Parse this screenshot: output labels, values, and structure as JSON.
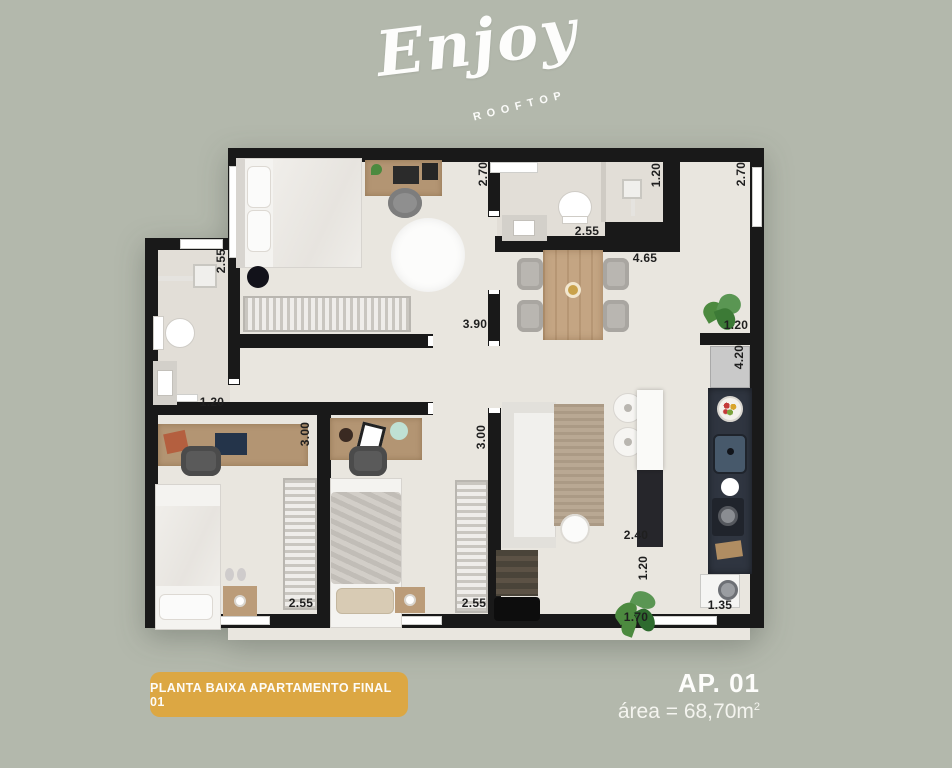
{
  "logo": {
    "brand": "Enjoy",
    "tagline": "ROOFTOP"
  },
  "plan": {
    "dimensions": [
      {
        "value": "2.70",
        "x": 338,
        "y": 28,
        "rot": true
      },
      {
        "value": "1.20",
        "x": 511,
        "y": 29,
        "rot": true
      },
      {
        "value": "2.70",
        "x": 596,
        "y": 28,
        "rot": true
      },
      {
        "value": "2.55",
        "x": 442,
        "y": 85,
        "rot": false
      },
      {
        "value": "4.65",
        "x": 500,
        "y": 112,
        "rot": false
      },
      {
        "value": "2.55",
        "x": 76,
        "y": 115,
        "rot": true
      },
      {
        "value": "3.90",
        "x": 330,
        "y": 178,
        "rot": false
      },
      {
        "value": "1.20",
        "x": 591,
        "y": 179,
        "rot": false
      },
      {
        "value": "4.20",
        "x": 594,
        "y": 211,
        "rot": true
      },
      {
        "value": "1.20",
        "x": 67,
        "y": 256,
        "rot": false
      },
      {
        "value": "3.00",
        "x": 160,
        "y": 288,
        "rot": true
      },
      {
        "value": "3.00",
        "x": 336,
        "y": 291,
        "rot": true
      },
      {
        "value": "2.40",
        "x": 491,
        "y": 389,
        "rot": false
      },
      {
        "value": "1.20",
        "x": 498,
        "y": 422,
        "rot": true
      },
      {
        "value": "2.55",
        "x": 156,
        "y": 457,
        "rot": false
      },
      {
        "value": "2.55",
        "x": 329,
        "y": 457,
        "rot": false
      },
      {
        "value": "1.70",
        "x": 491,
        "y": 471,
        "rot": false
      },
      {
        "value": "1.35",
        "x": 575,
        "y": 459,
        "rot": false
      }
    ]
  },
  "footer": {
    "badge_label": "PLANTA BAIXA APARTAMENTO FINAL 01",
    "unit_label": "AP. 01",
    "area_label": "área = 68,70m",
    "area_exponent": "2"
  },
  "colors": {
    "background": "#b3b8ac",
    "wall": "#191919",
    "floor": "#e9e6df",
    "badge": "#dca743",
    "kitchen_counter": "#2f3540",
    "dimension_text": "#1f1f1f"
  }
}
